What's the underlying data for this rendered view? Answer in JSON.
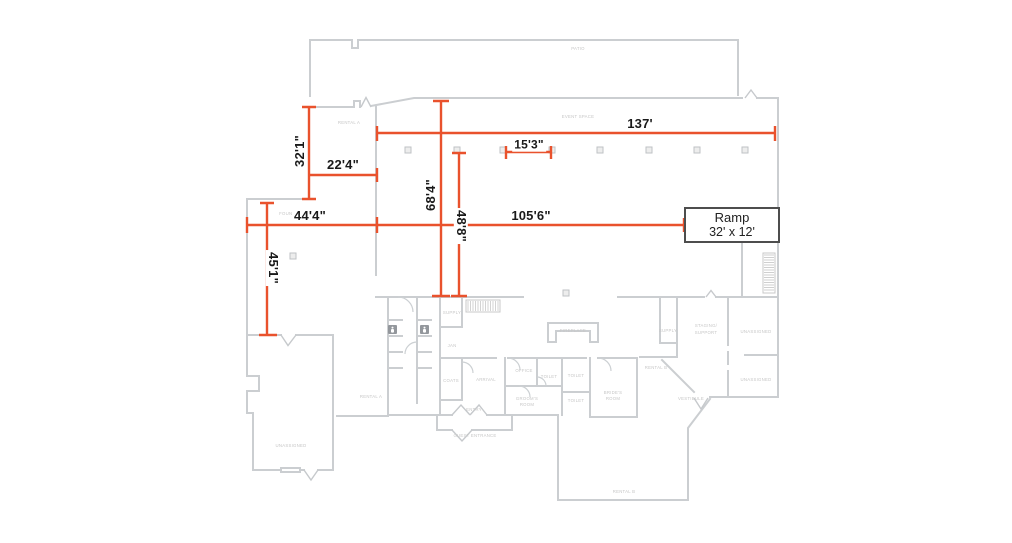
{
  "colors": {
    "dimension_accent": "#E9522D",
    "wall_gray": "#cbced1",
    "room_label_gray": "#c6c6c6",
    "dimension_text": "#1a1a1a"
  },
  "dimensions": [
    {
      "id": "event-space-width",
      "value": "137'"
    },
    {
      "id": "column-spacing",
      "value": "15'3\""
    },
    {
      "id": "rental-a-width",
      "value": "22'4\""
    },
    {
      "id": "rental-a-depth",
      "value": "32'1\""
    },
    {
      "id": "fountain-width",
      "value": "44'4\""
    },
    {
      "id": "hall-width",
      "value": "105'6\""
    },
    {
      "id": "fountain-depth",
      "value": "45'1\""
    },
    {
      "id": "event-space-depth",
      "value": "68'4\""
    },
    {
      "id": "event-inner-depth",
      "value": "48'8\""
    }
  ],
  "ramp": {
    "label": "Ramp",
    "size": "32' x 12'"
  },
  "rooms": [
    {
      "label": "PATIO"
    },
    {
      "label": "EVENT SPACE"
    },
    {
      "label": "RENTAL A"
    },
    {
      "label": "FOUNTAIN"
    },
    {
      "label": "RENTAL A"
    },
    {
      "label": "UNASSIGNED"
    },
    {
      "label": "SUPPLY"
    },
    {
      "label": "JAN"
    },
    {
      "label": "COATS"
    },
    {
      "label": "ARRIVAL"
    },
    {
      "label": "ENTRY"
    },
    {
      "label": "GUEST ENTRANCE"
    },
    {
      "label": "FIREPLACE"
    },
    {
      "label": "OFFICE"
    },
    {
      "label": "TOILET"
    },
    {
      "label": "TOILET"
    },
    {
      "label": "TOILET"
    },
    {
      "label": "GROOM'S"
    },
    {
      "label": "ROOM"
    },
    {
      "label": "BRIDE'S"
    },
    {
      "label": "ROOM"
    },
    {
      "label": "RENTAL B"
    },
    {
      "label": "SUPPLY"
    },
    {
      "label": "STAGING/"
    },
    {
      "label": "SUPPORT"
    },
    {
      "label": "UNASSIGNED"
    },
    {
      "label": "UNASSIGNED"
    },
    {
      "label": "VESTIBULE"
    },
    {
      "label": "RENTAL B"
    }
  ]
}
